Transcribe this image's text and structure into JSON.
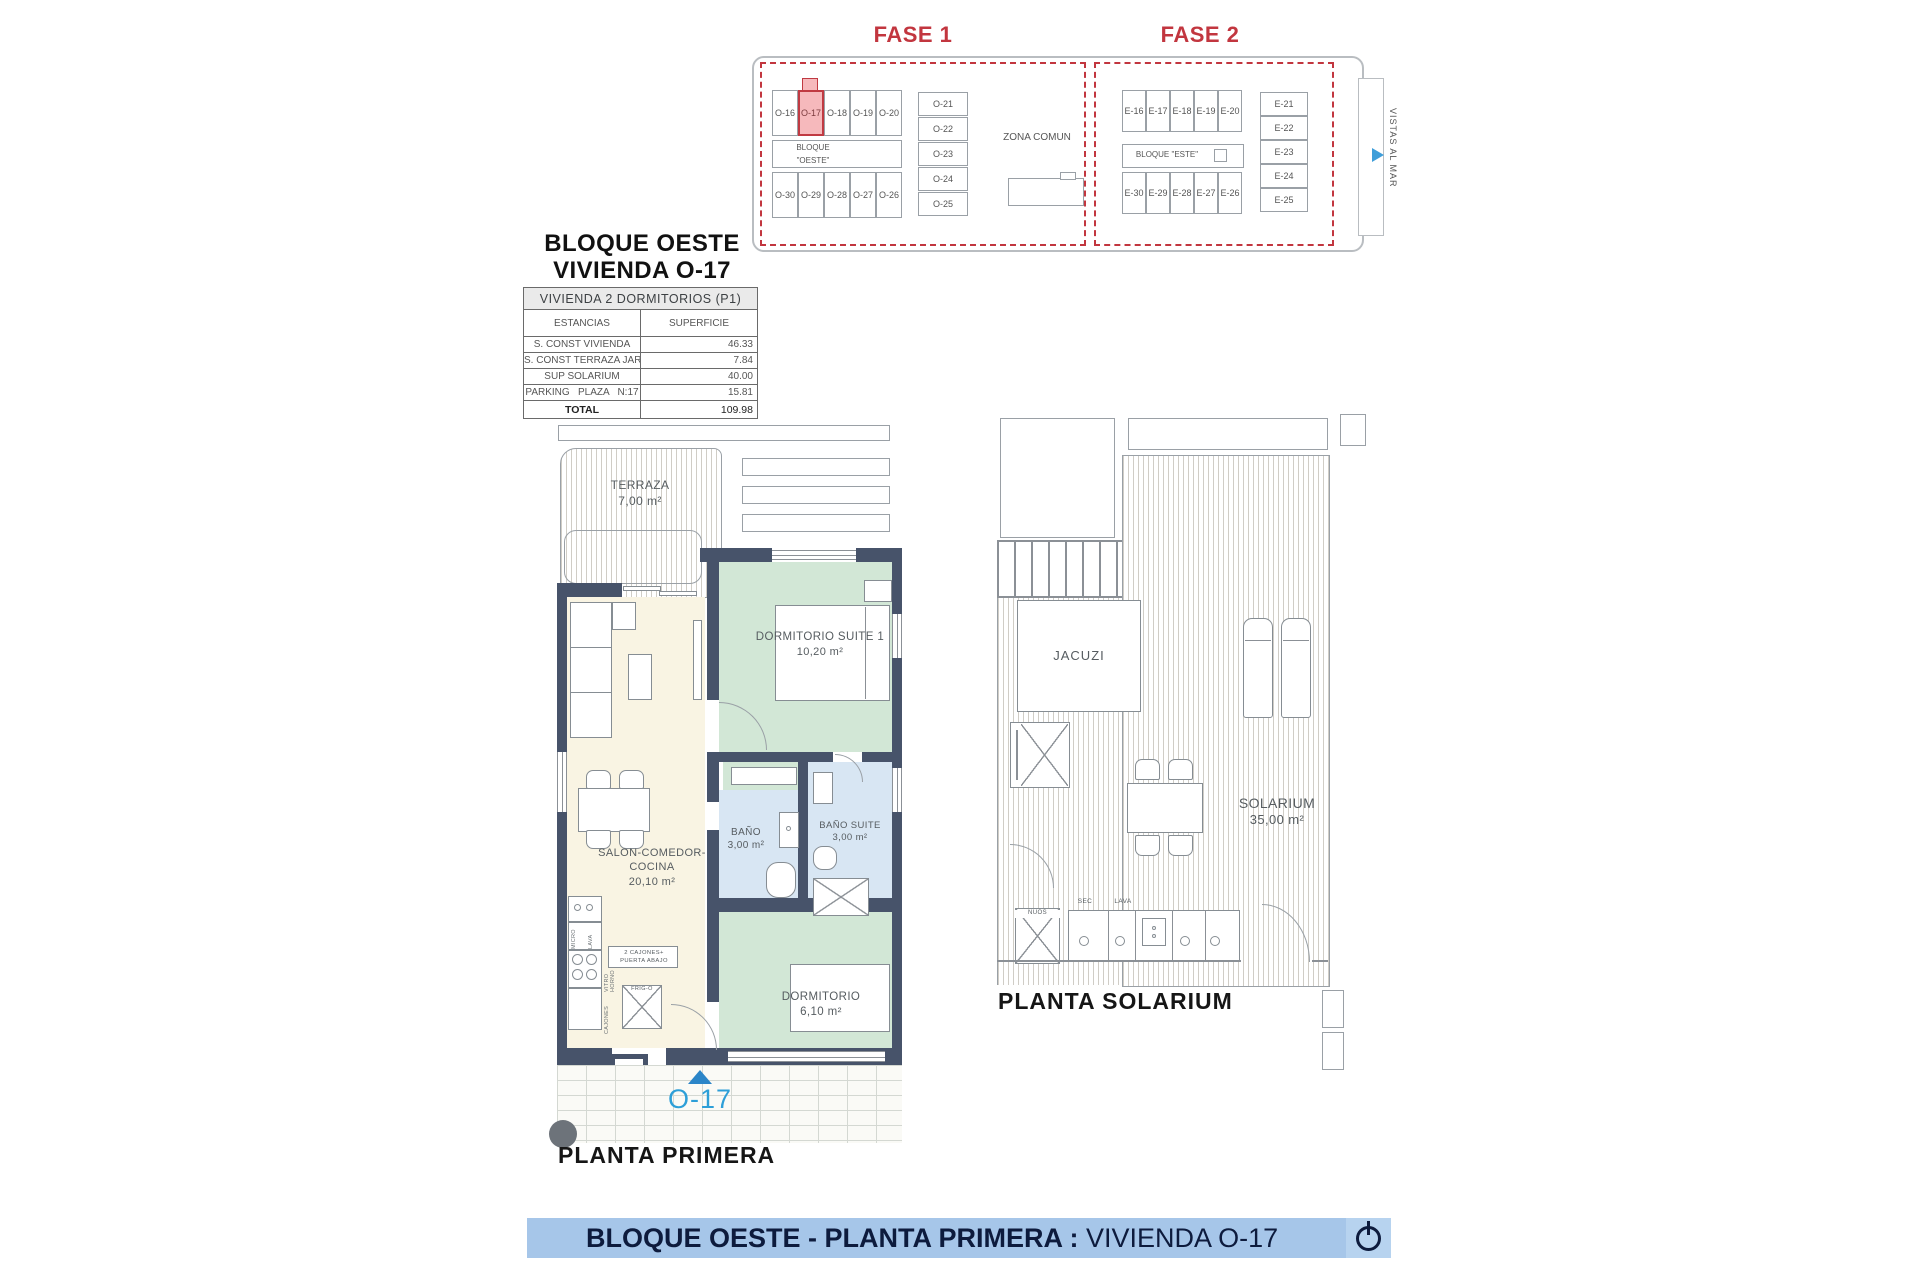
{
  "title": {
    "line1": "BLOQUE OESTE",
    "line2": "VIVIENDA O-17"
  },
  "site_plan": {
    "fase1": "FASE 1",
    "fase2": "FASE 2",
    "bloque_oeste_line1": "BLOQUE",
    "bloque_oeste_line2": "\"OESTE\"",
    "bloque_este": "BLOQUE \"ESTE\"",
    "zona_comun": "ZONA COMUN",
    "vistas_al_mar": "VISTAS AL MAR",
    "highlighted_unit": "O-17",
    "oeste_top": [
      "O-16",
      "O-17",
      "O-18",
      "O-19",
      "O-20"
    ],
    "oeste_col": [
      "O-21",
      "O-22",
      "O-23",
      "O-24",
      "O-25"
    ],
    "oeste_bottom": [
      "O-30",
      "O-29",
      "O-28",
      "O-27",
      "O-26"
    ],
    "este_top": [
      "E-16",
      "E-17",
      "E-18",
      "E-19",
      "E-20"
    ],
    "este_col": [
      "E-21",
      "E-22",
      "E-23",
      "E-24",
      "E-25"
    ],
    "este_bottom": [
      "E-30",
      "E-29",
      "E-28",
      "E-27",
      "E-26"
    ]
  },
  "area_table": {
    "header": "VIVIENDA 2 DORMITORIOS (P1)",
    "col_estancias": "ESTANCIAS",
    "col_superficie": "SUPERFICIE",
    "rows": [
      {
        "label": "S. CONST VIVIENDA",
        "value": "46.33"
      },
      {
        "label": "S. CONST TERRAZA JARDÍN",
        "value": "7.84"
      },
      {
        "label": "SUP SOLARIUM",
        "value": "40.00"
      },
      {
        "label": "PARKING   PLAZA   N:17",
        "value": "15.81"
      }
    ],
    "total_label": "TOTAL",
    "total_value": "109.98"
  },
  "floor_plan": {
    "caption": "PLANTA PRIMERA",
    "unit_marker": "O-17",
    "terraza_name": "TERRAZA",
    "terraza_area": "7,00 m²",
    "suite_name": "DORMITORIO SUITE 1",
    "suite_area": "10,20 m²",
    "salon_name": "SALON-COMEDOR-COCINA",
    "salon_area": "20,10 m²",
    "bano_name": "BAÑO",
    "bano_area": "3,00 m²",
    "bano_suite_name": "BAÑO SUITE",
    "bano_suite_area": "3,00 m²",
    "dormitorio_name": "DORMITORIO",
    "dormitorio_area": "6,10 m²",
    "kitchen": {
      "micro": "MICRO",
      "lava": "LAVA",
      "vitro_horno": "VITRO HORNO",
      "cajones": "CAJONES",
      "frigo": "FRIG-O",
      "note_line1": "2 CAJONES+",
      "note_line2": "PUERTA ABAJO"
    }
  },
  "solarium_plan": {
    "caption": "PLANTA SOLARIUM",
    "jacuzi": "JACUZI",
    "solarium_name": "SOLARIUM",
    "solarium_area": "35,00 m²",
    "sec": "SEC",
    "lava": "LAVA",
    "storage_box": "NUOS"
  },
  "footer": {
    "title_bold": "BLOQUE OESTE - PLANTA PRIMERA",
    "separator": " : ",
    "title_unit": "VIVIENDA O-17"
  },
  "colors": {
    "accent_red": "#c2363f",
    "wall": "#47536a",
    "room_green": "#d2e7d6",
    "room_cream": "#f9f4e3",
    "room_blue": "#d8e6f3",
    "highlight_pink": "#f6b9bc",
    "banner_blue": "#a6c6e9",
    "marker_blue": "#2d9fd8"
  }
}
